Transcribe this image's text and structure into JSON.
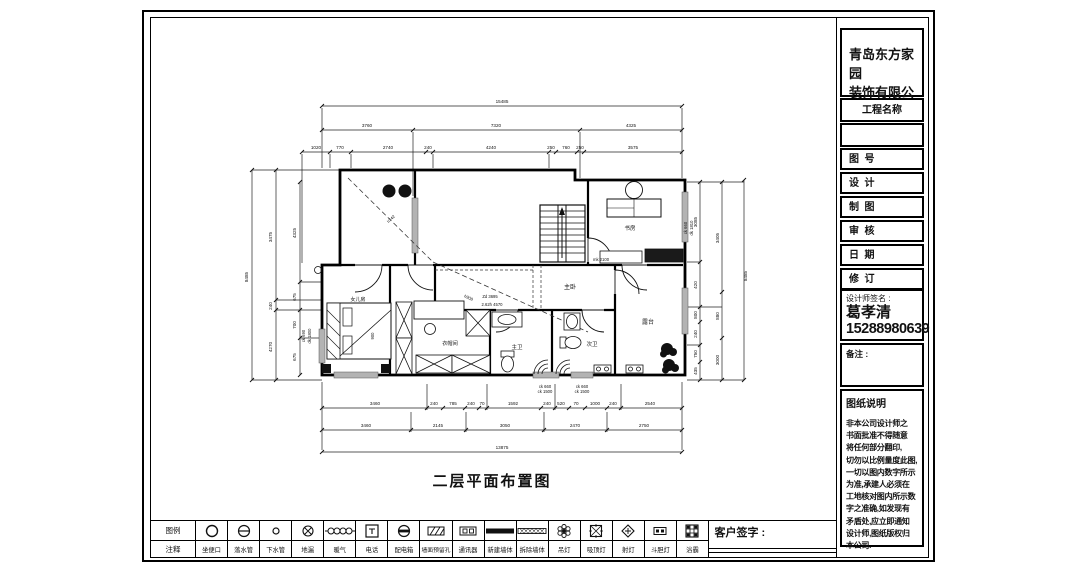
{
  "title_block": {
    "company_line1": "青岛东方家园",
    "company_line2": "装饰有限公司",
    "project_label": "工程名称",
    "rows": [
      "图  号",
      "设  计",
      "制  图",
      "审  核",
      "日  期",
      "修  订"
    ],
    "signer_label": "设计师签名 :",
    "signer_name": "葛孝清",
    "signer_phone": "15288980639",
    "notes_label": "备注 :",
    "instructions_title": "图纸说明",
    "instructions_lines": [
      "非本公司设计师之",
      "书面批准不得随意",
      "将任何部分翻印,",
      "切勿以比例量度此图,",
      "一切以图内数字所示",
      "为准,承建人必须在",
      "工地核对图内所示数",
      "字之准确,如发现有",
      "矛盾处,应立即通知",
      "设计师,图纸版权归",
      "本公司."
    ]
  },
  "drawing": {
    "title": "二层平面布置图",
    "rooms": {
      "study": "书房",
      "master": "主卧",
      "terrace": "露台",
      "cloakroom": "衣帽间",
      "master_bath": "主卫",
      "second_bath": "次卫",
      "kids": "女儿房"
    },
    "annotations": {
      "slope1": "h742",
      "slope2": "h908",
      "center1": "Zd 3695",
      "center2": "2.62h 4570",
      "door": "mk 2100",
      "bed_width": "900"
    },
    "win_marks": {
      "left1": "ck 690",
      "left2": "dk 1800",
      "right1": "ck 660",
      "right2": "dk 1810",
      "b1a": "ck 660",
      "b1b": "ck 1500",
      "b2a": "ck 660",
      "b2b": "ck 1500"
    },
    "dims": {
      "top_total": "15485",
      "top_row2": [
        "3760",
        "7320",
        "4325"
      ],
      "top_row3": [
        "1020",
        "770",
        "2740",
        "240",
        "4240",
        "250",
        "760",
        "250",
        "3575"
      ],
      "bottom_row1": [
        "3460",
        "240",
        "785",
        "240",
        "70",
        "1592",
        "240",
        "520",
        "70",
        "1000",
        "240",
        "2540"
      ],
      "bottom_row2": [
        "3460",
        "2145",
        "3050",
        "2470",
        "2750"
      ],
      "bottom_total": "13875",
      "left_total": "8485",
      "left_mid": [
        "3475",
        "240",
        "4270"
      ],
      "left_inner": [
        "4325",
        "675",
        "700",
        "675"
      ],
      "right_inner": [
        "3085",
        "420",
        "800",
        "240",
        "750",
        "435"
      ],
      "right_mid": [
        "3405",
        "880",
        "3000"
      ],
      "right_total": "8485"
    }
  },
  "legend": {
    "header_top": "图例",
    "header_bottom": "注释",
    "items": [
      {
        "name": "toilet",
        "label": "坐便口"
      },
      {
        "name": "downpipe",
        "label": "落水管"
      },
      {
        "name": "sewer-pipe",
        "label": "下水管"
      },
      {
        "name": "floor-drain",
        "label": "地漏"
      },
      {
        "name": "radiator",
        "label": "暖气"
      },
      {
        "name": "telephone",
        "label": "电话"
      },
      {
        "name": "distribution-box",
        "label": "配电箱"
      },
      {
        "name": "wall-reserved-hole",
        "label": "墙面预留孔"
      },
      {
        "name": "intercom",
        "label": "通讯器"
      },
      {
        "name": "new-wall",
        "label": "新建墙体"
      },
      {
        "name": "demolished-wall",
        "label": "拆除墙体"
      },
      {
        "name": "pendant-light",
        "label": "吊灯"
      },
      {
        "name": "ceiling-light",
        "label": "吸顶灯"
      },
      {
        "name": "spotlight",
        "label": "射灯"
      },
      {
        "name": "recessed-light",
        "label": "斗胆灯"
      },
      {
        "name": "bath-heater",
        "label": "浴霸"
      }
    ]
  },
  "customer_label": "客户签字 :"
}
